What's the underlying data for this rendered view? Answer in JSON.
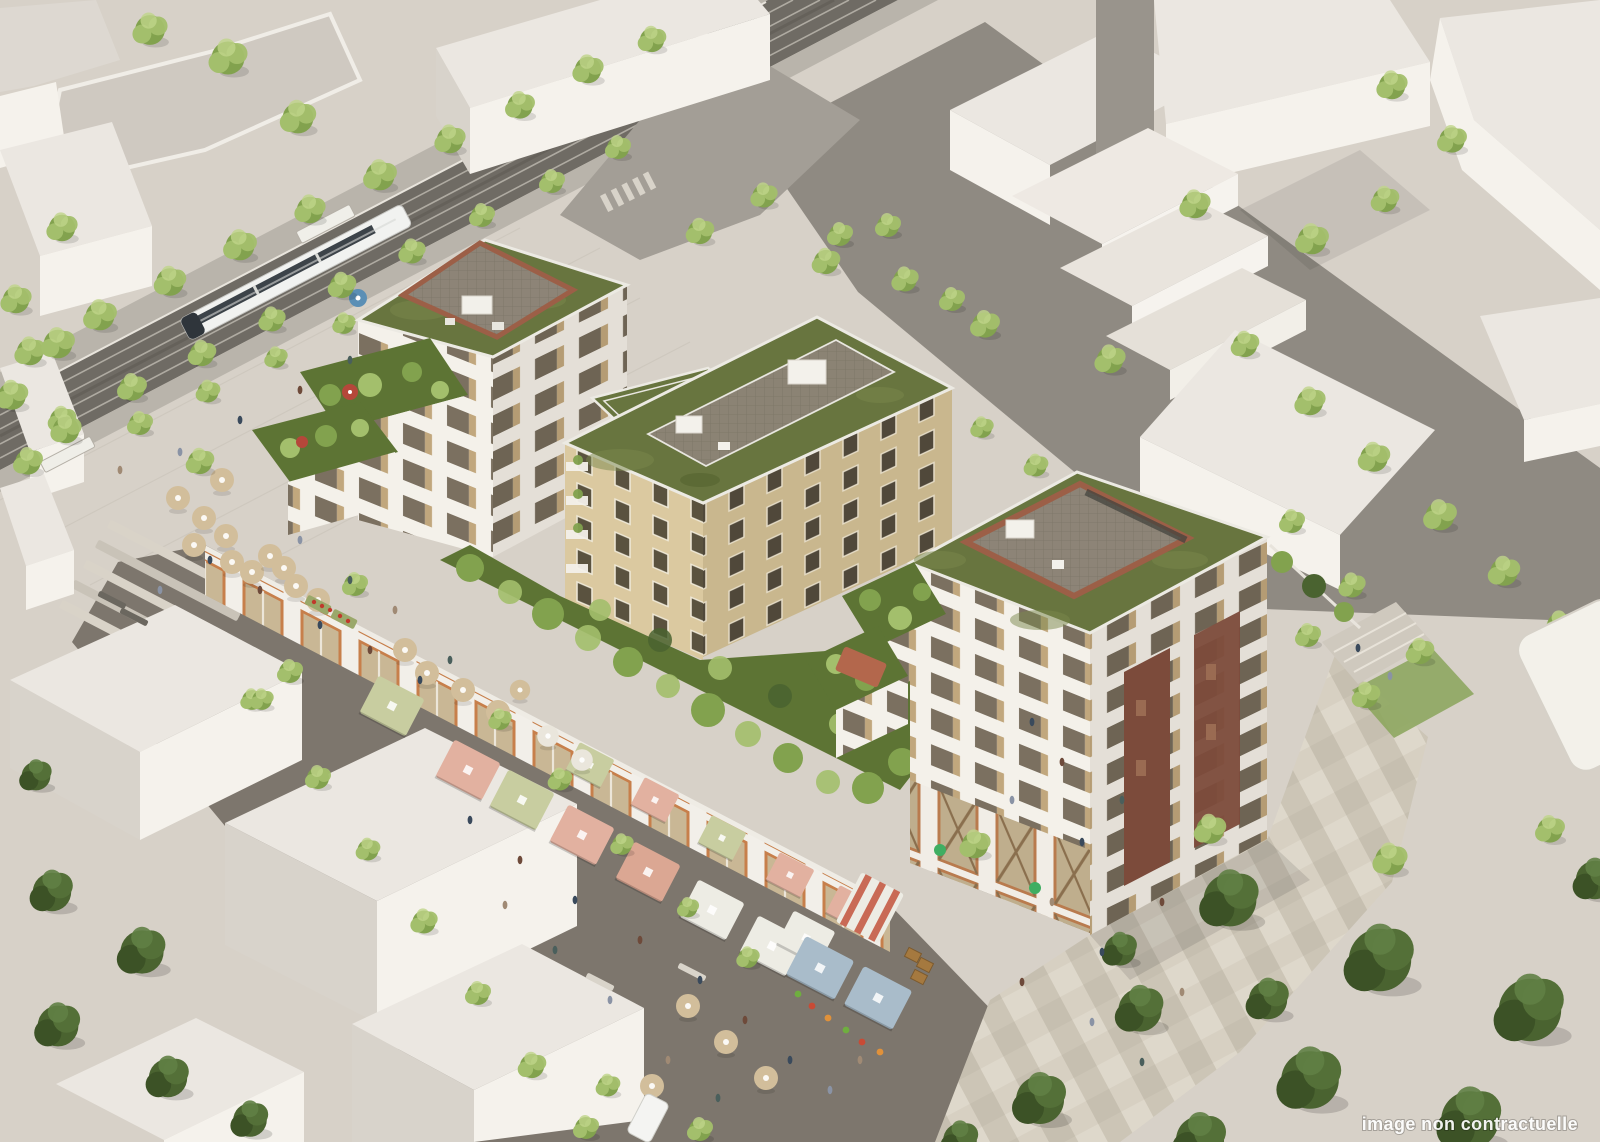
{
  "image": {
    "watermark_text": "image non contractuelle"
  },
  "palette": {
    "ground": "#d7d1c8",
    "asphalt": "#8f8a82",
    "trackbed": "#6f6b64",
    "marketRoad": "#7d766d",
    "ctxTop": "#ebe7e1",
    "ctxLit": "#f5f2ec",
    "ctxShade": "#d8d3cb",
    "whiteFacade": "#f4f1ea",
    "whiteShade": "#e4dfd7",
    "beigeLit": "#dbc9a0",
    "beigeShade": "#c9b78e",
    "glass": "#7b7060",
    "shutter": "#c1a77d",
    "roofGreen": "#68753f",
    "gardenGreen": "#5d7434",
    "treeLight": "#a3bf6c",
    "treeMid": "#82a24e",
    "treeDark": "#4a6330",
    "brick": "#9c5f47",
    "paver": "#8d8477",
    "canopyPink": "#e2b1a0",
    "canopySage": "#c8cda0",
    "canopyWhite": "#edece4",
    "canopyBlue": "#a9bcca",
    "parasolTan": "#d2be9b",
    "tramWhite": "#f1f2f0",
    "watermark": "#ffffff"
  }
}
